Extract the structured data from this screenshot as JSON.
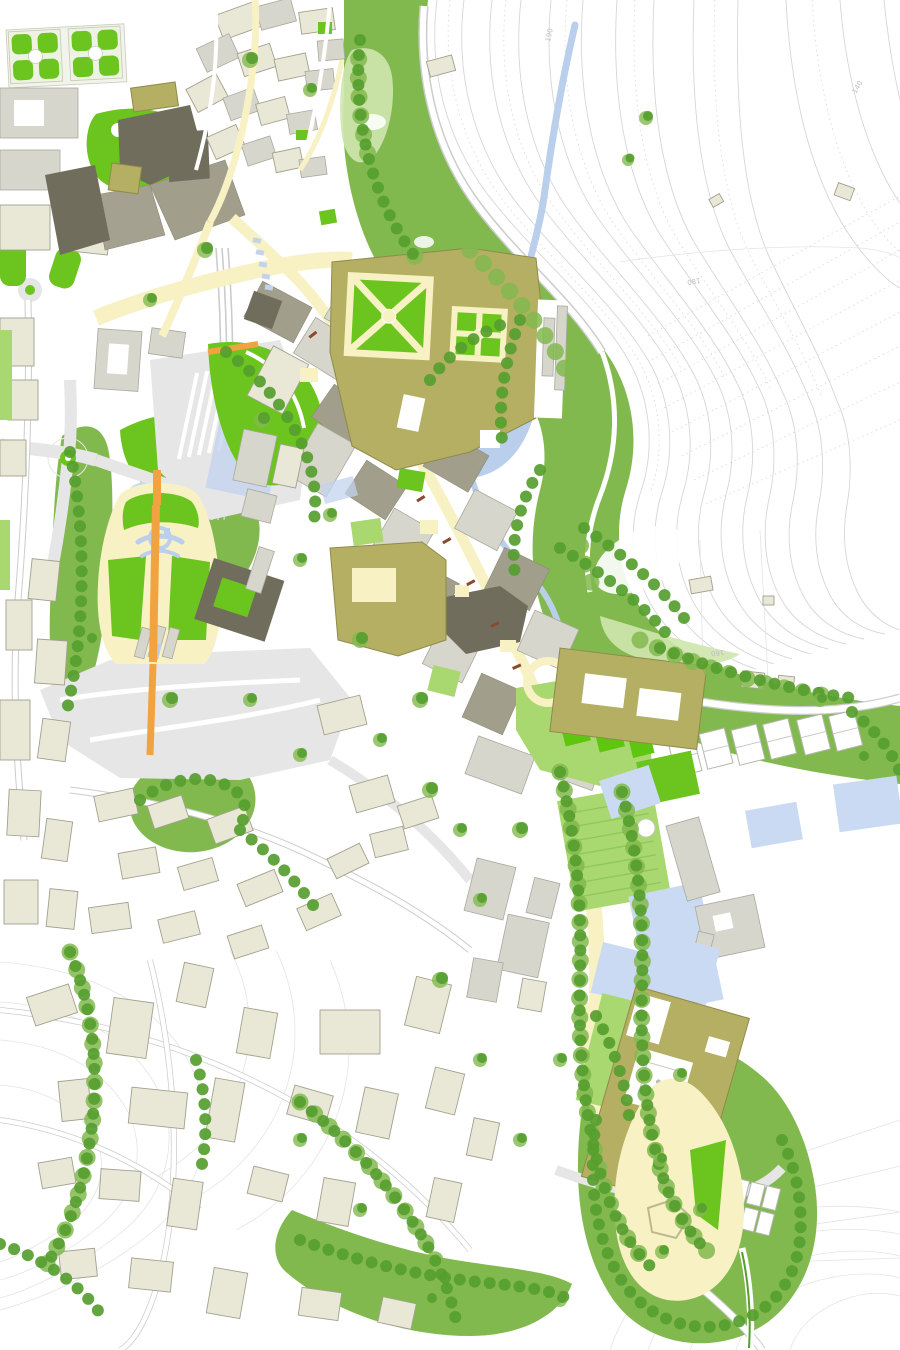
{
  "map": {
    "type": "urban-masterplan-map",
    "contour_labels": [
      "190",
      "180",
      "160",
      "140"
    ],
    "features": [
      "formal-garden-parterre",
      "old-town-blocks",
      "main-street-spine",
      "palace-garden-squares",
      "olive-institutional-complex",
      "river",
      "valley-woodland",
      "hillside-contours",
      "bell-shaped-park",
      "railway-station-area",
      "sports-pitches",
      "tennis-courts",
      "water-gardens",
      "monastery-complex",
      "tree-lined-avenue",
      "teardrop-park",
      "residential-district"
    ]
  },
  "palette": {
    "contour_line": "#d6d6d6",
    "contour_faint": "#e4e4e4",
    "park_green": "#6cc41f",
    "pitch_green": "#5ec60e",
    "lawn_light": "#a9d870",
    "veg_medium": "#82b94f",
    "veg_dark": "#569e2f",
    "veg_pale": "#cfe6ae",
    "water": "#b9cfec",
    "water_light": "#c9daf2",
    "street_cream": "#f8f1c4",
    "path_orange": "#f2a341",
    "accent_rust": "#8a4a2e",
    "bldg_olive": "#b4af62",
    "bldg_olive_edge": "#8f8a4a",
    "bldg_beige": "#e9e7d6",
    "bldg_outline": "#a2a18e",
    "bldg_gray": "#d7d6cd",
    "bldg_taupe": "#a29e8c",
    "bldg_dark": "#716d5c",
    "road_gray": "#e6e6e6",
    "road_casing": "#cccccc",
    "rail_blue": "#c3d3ee",
    "label_gray": "#bdbdbd"
  }
}
